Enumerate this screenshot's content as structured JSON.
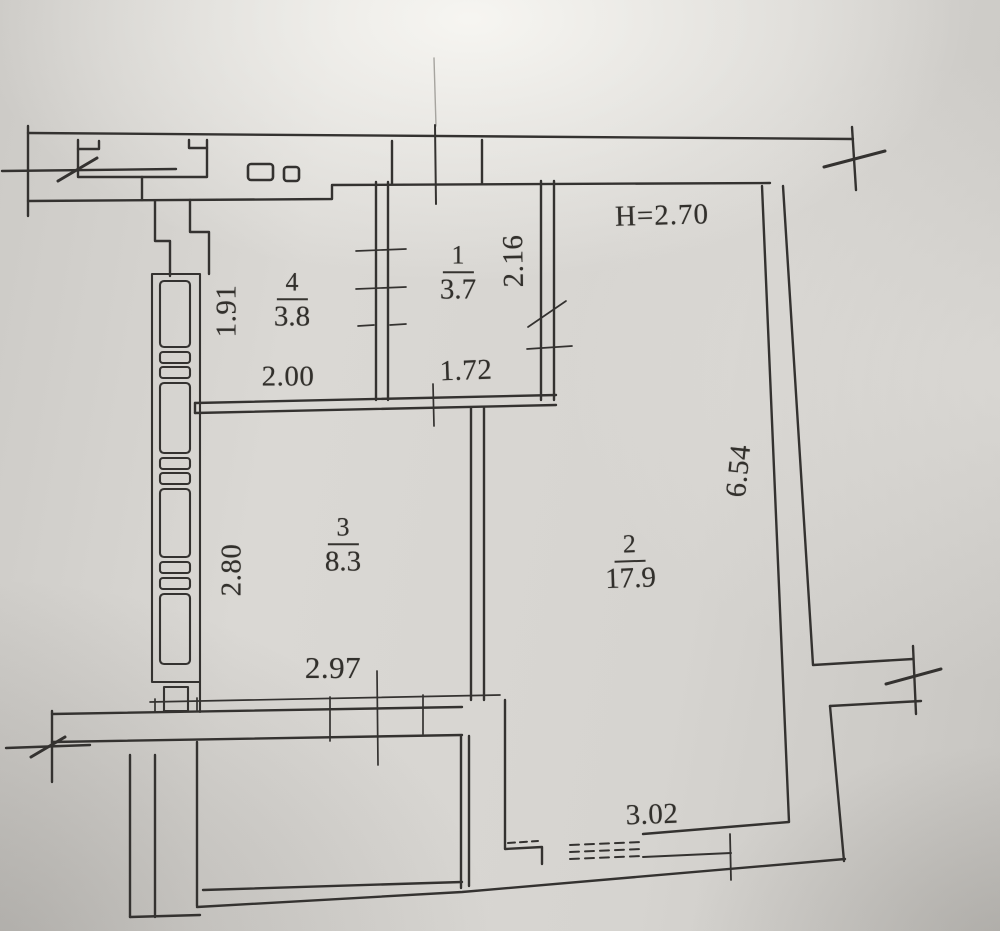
{
  "plan": {
    "height_note": "H=2.70",
    "rooms": {
      "r1": {
        "number": "1",
        "area": "3.7"
      },
      "r2": {
        "number": "2",
        "area": "17.9"
      },
      "r3": {
        "number": "3",
        "area": "8.3"
      },
      "r4": {
        "number": "4",
        "area": "3.8"
      }
    },
    "dims": {
      "room4_height": "1.91",
      "room4_width": "2.00",
      "room1_height": "2.16",
      "room1_width": "1.72",
      "room3_height": "2.80",
      "room3_width": "2.97",
      "room2_height": "6.54",
      "room2_width": "3.02"
    },
    "colors": {
      "paper": "#d6d4d0",
      "ink": "#343230"
    }
  }
}
